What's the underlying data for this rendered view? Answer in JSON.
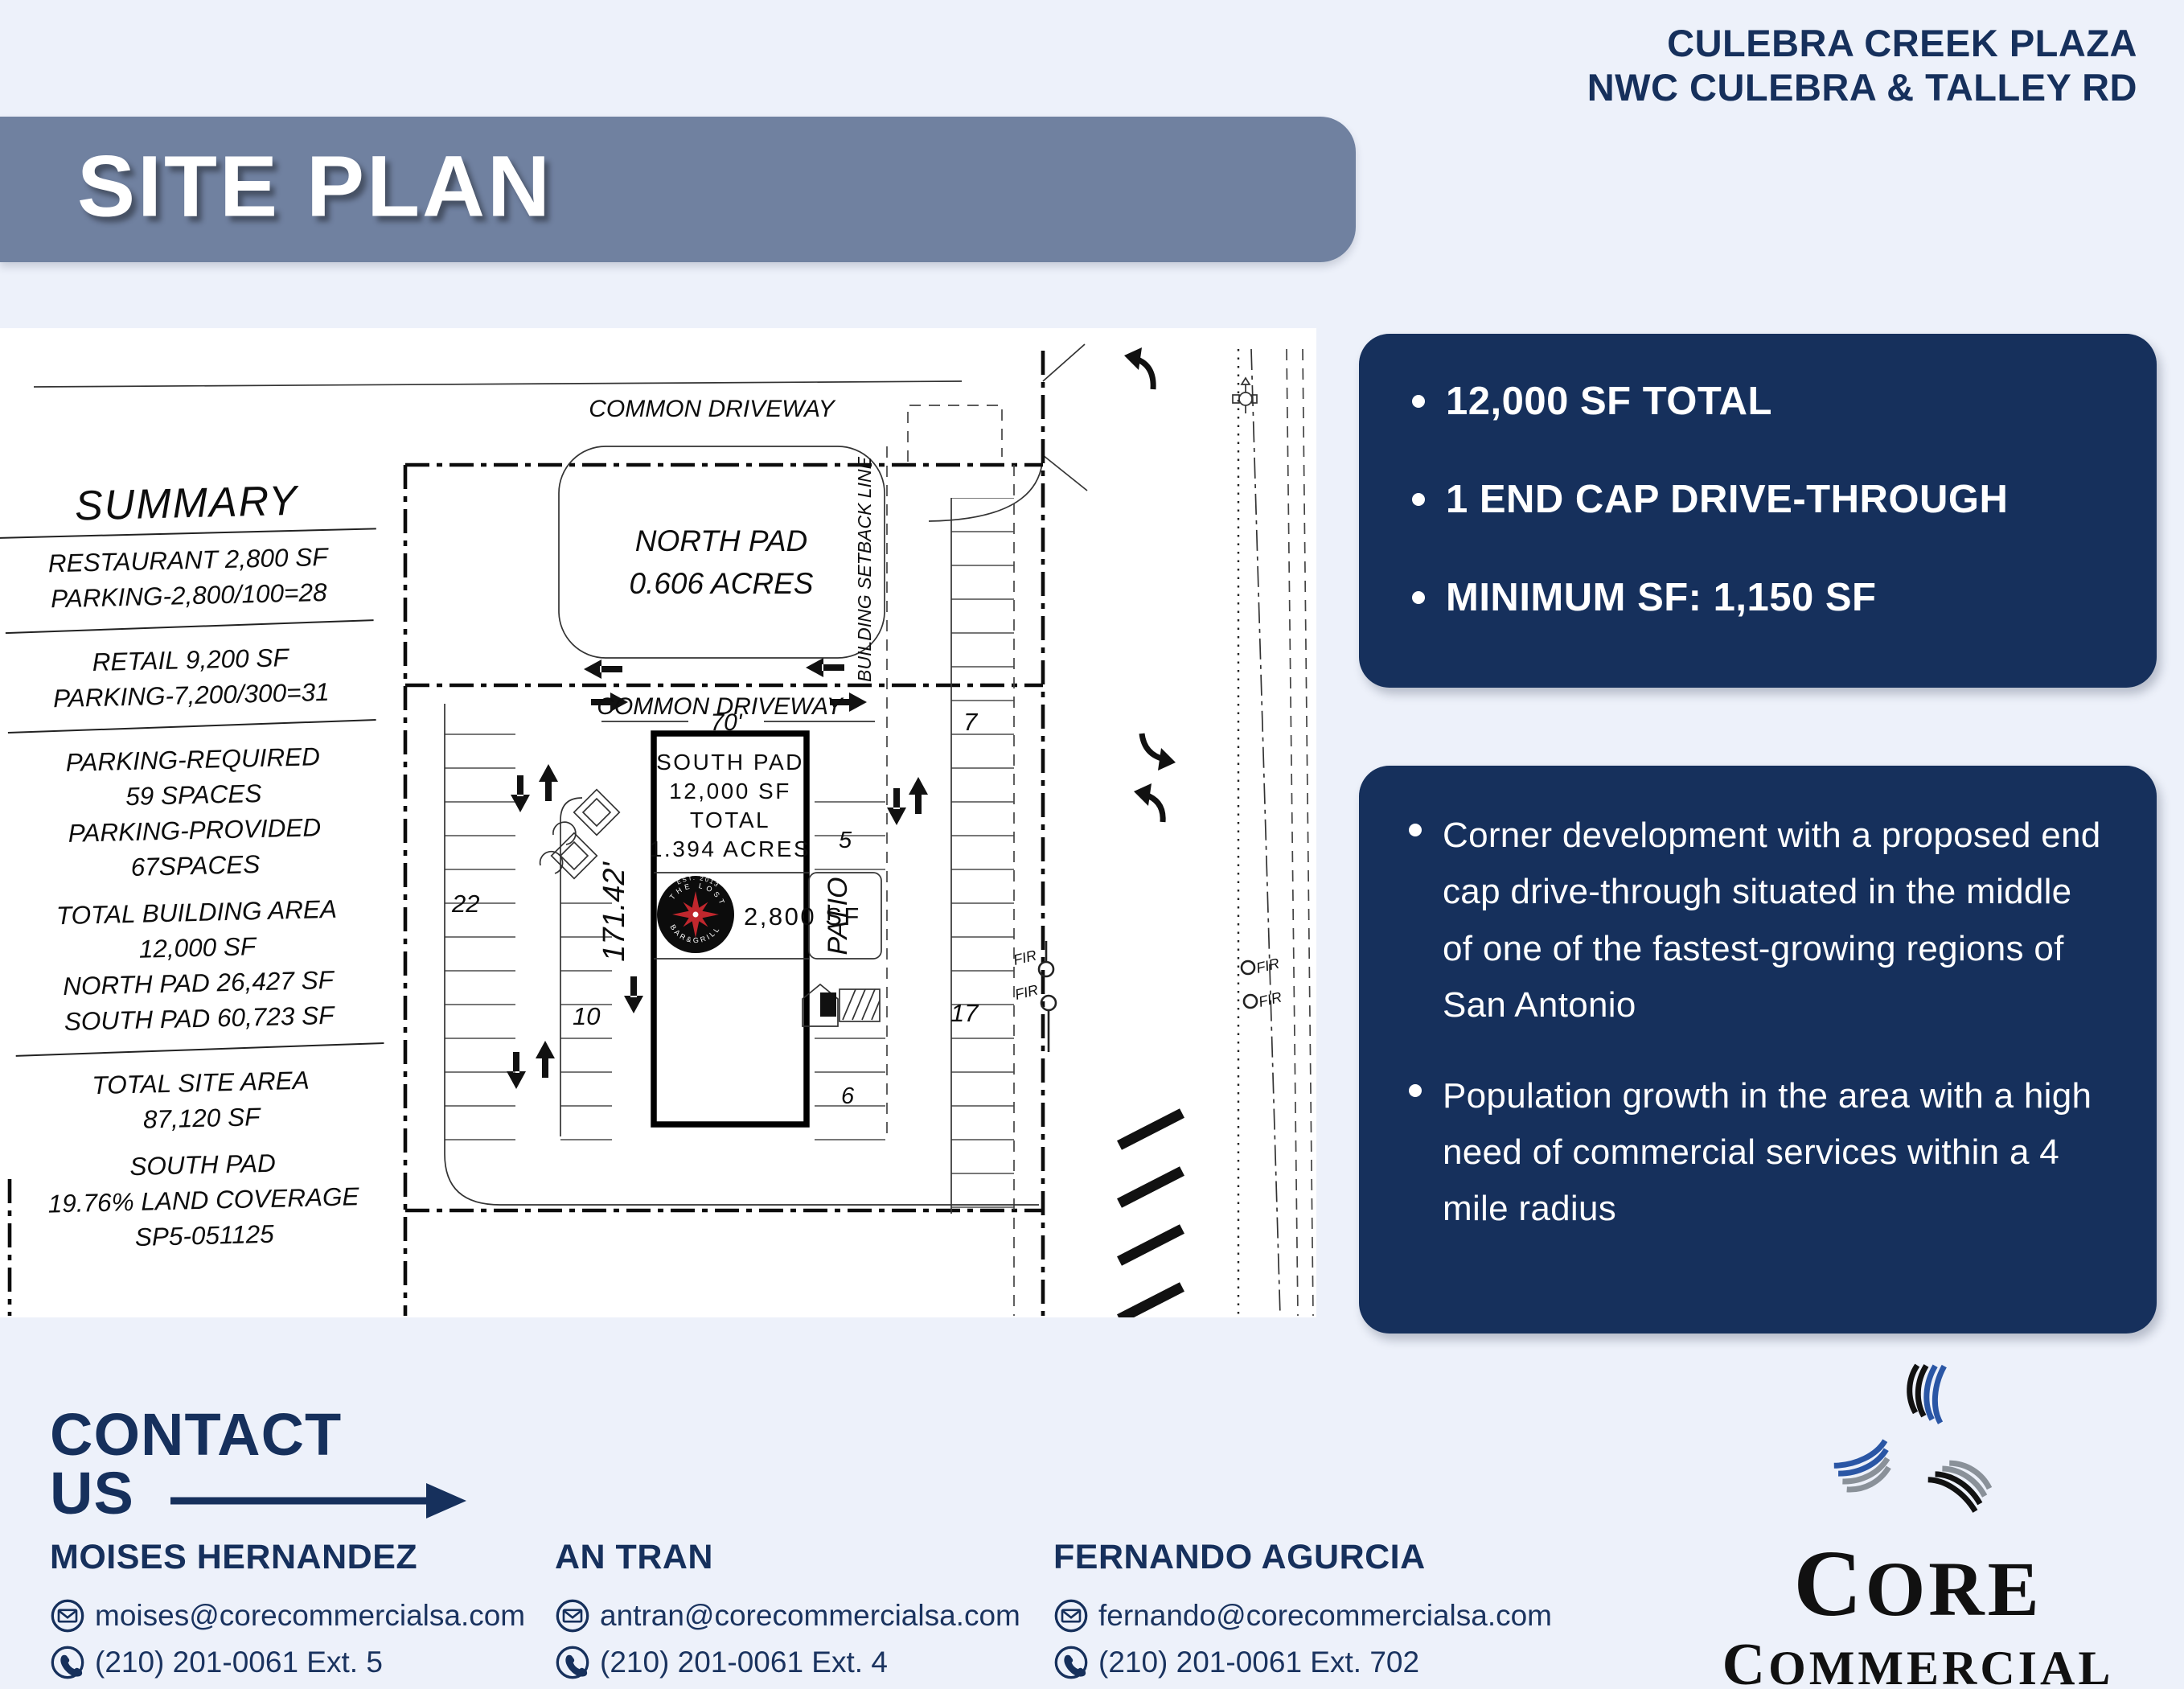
{
  "colors": {
    "background": "#edf1fa",
    "navy": "#16305c",
    "banner_slate": "#7081a0",
    "logo_blue": "#2a56a5",
    "logo_gray": "#8a9199",
    "logo_red": "#c0272d"
  },
  "header": {
    "line1": "CULEBRA CREEK PLAZA",
    "line2": "NWC CULEBRA & TALLEY RD"
  },
  "banner": {
    "title": "SITE PLAN"
  },
  "summary": {
    "title": "SUMMARY",
    "lines": [
      "RESTAURANT 2,800 SF",
      "PARKING-2,800/100=28",
      "RETAIL 9,200 SF",
      "PARKING-7,200/300=31",
      "PARKING-REQUIRED",
      "59 SPACES",
      "PARKING-PROVIDED",
      "67SPACES",
      "TOTAL BUILDING AREA",
      "12,000 SF",
      "NORTH PAD 26,427 SF",
      "SOUTH PAD 60,723 SF",
      "TOTAL SITE AREA",
      "87,120 SF",
      "SOUTH PAD",
      "19.76% LAND COVERAGE",
      "SP5-051125"
    ]
  },
  "plan": {
    "common_driveway_top": "COMMON DRIVEWAY",
    "common_driveway_mid": "COMMON DRIVEWAY",
    "north_pad_name": "NORTH PAD",
    "north_pad_acres": "0.606 ACRES",
    "building_setback": "BUILDING SETBACK LINE",
    "dim_width": "70'",
    "dim_depth": "171.42'",
    "south_pad_line1": "SOUTH PAD",
    "south_pad_line2": "12,000 SF",
    "south_pad_line3": "TOTAL",
    "south_pad_line4": "1.394 ACRES",
    "restaurant_sf": "2,800 SF",
    "patio": "PATIO",
    "counts": {
      "left_col": "22",
      "mid_col": "10",
      "east_upper": "7",
      "east_lower": "17",
      "right_upper": "5",
      "right_lower": "6"
    },
    "fir": "FIR",
    "tenant_logo": {
      "est": "EST. 2013",
      "top": "THE LOST",
      "bottom": "BAR&GRILL"
    }
  },
  "highlights_box": {
    "items": [
      "12,000 SF TOTAL",
      "1 END CAP DRIVE-THROUGH",
      "MINIMUM SF: 1,150 SF"
    ]
  },
  "details_box": {
    "items": [
      "Corner development with a proposed end cap drive-through situated in the middle of one of the fastest-growing regions of San Antonio",
      "Population growth in the area with a high need of commercial services within a 4 mile radius"
    ]
  },
  "contact": {
    "title_line1": "CONTACT",
    "title_line2": "US",
    "people": [
      {
        "name": "MOISES HERNANDEZ",
        "email": "moises@corecommercialsa.com",
        "phone": "(210) 201-0061 Ext. 5"
      },
      {
        "name": "AN TRAN",
        "email": "antran@corecommercialsa.com",
        "phone": "(210) 201-0061 Ext. 4"
      },
      {
        "name": "FERNANDO AGURCIA",
        "email": "fernando@corecommercialsa.com",
        "phone": "(210) 201-0061 Ext. 702"
      }
    ]
  },
  "brand": {
    "word1": "CORE",
    "word2": "COMMERCIAL",
    "website": "www.corecommercialsa.com"
  }
}
